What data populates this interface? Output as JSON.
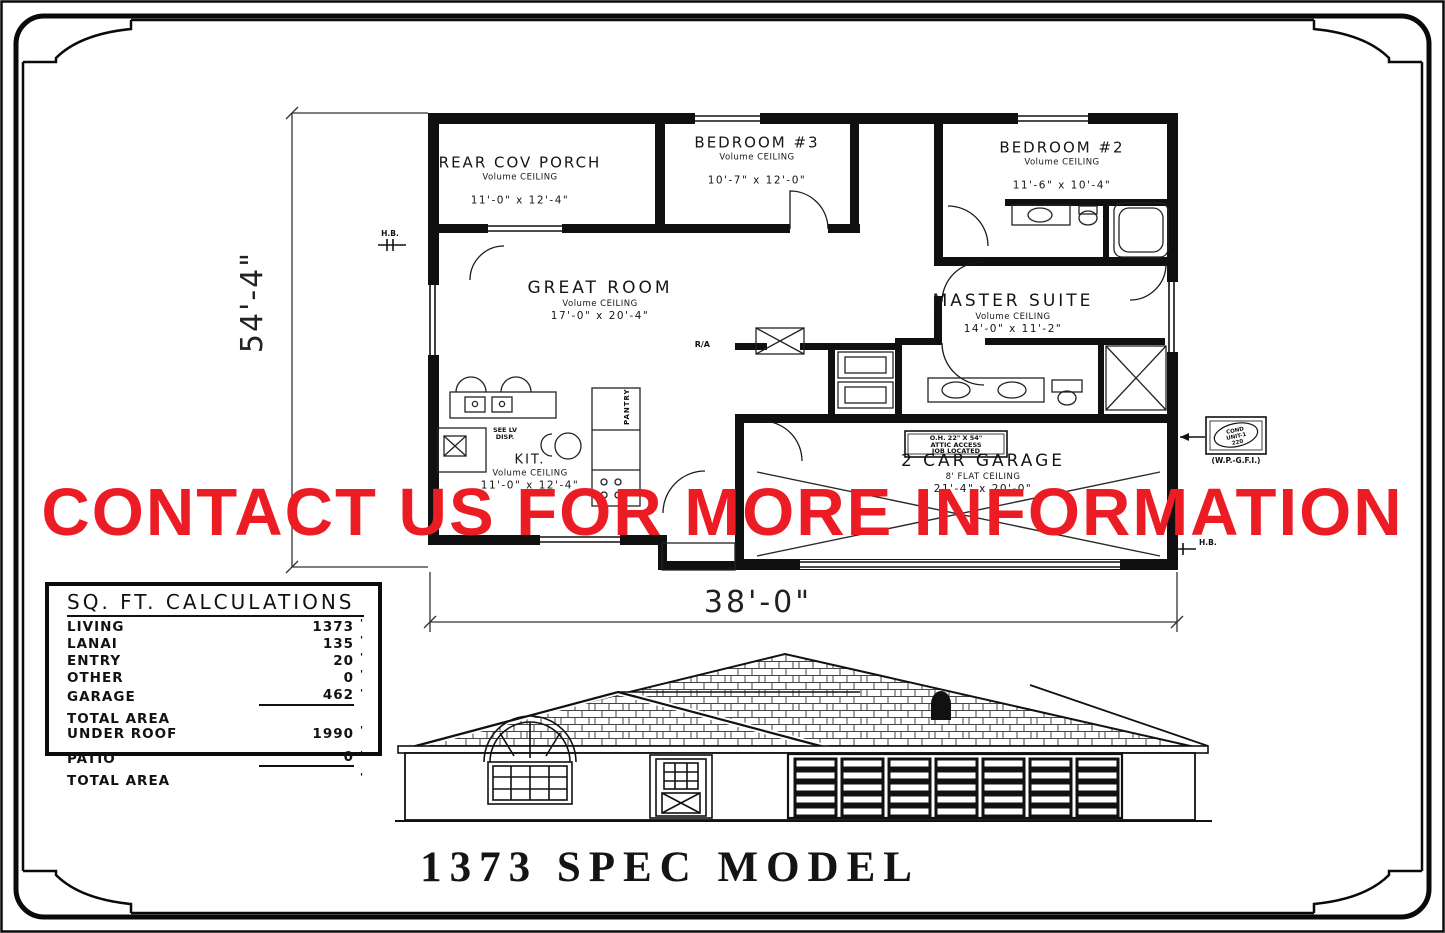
{
  "watermark": {
    "text": "CONTACT US FOR MORE INFORMATION",
    "color": "#ec1c24"
  },
  "title_block": {
    "text": "1373 SPEC MODEL"
  },
  "dims": {
    "height_label": "54'-4\"",
    "width_label": "38'-0\""
  },
  "rooms": [
    {
      "name": "REAR COV PORCH",
      "ceiling": "Volume CEILING",
      "size": "11'-0\" x 12'-4\""
    },
    {
      "name": "BEDROOM #3",
      "ceiling": "Volume CEILING",
      "size": "10'-7\" x 12'-0\""
    },
    {
      "name": "BEDROOM #2",
      "ceiling": "Volume CEILING",
      "size": "11'-6\" x 10'-4\""
    },
    {
      "name": "GREAT ROOM",
      "ceiling": "Volume CEILING",
      "size": "17'-0\" x 20'-4\""
    },
    {
      "name": "MASTER SUITE",
      "ceiling": "Volume CEILING",
      "size": "14'-0\" x 11'-2\""
    },
    {
      "name": "KIT.",
      "ceiling": "Volume CEILING",
      "size": "11'-0\" x 12'-4\""
    },
    {
      "name": "2 CAR GARAGE",
      "ceiling": "8' FLAT CEILING",
      "size": "21'-4\" x 20'-0\""
    }
  ],
  "ann": {
    "hb": "H.B.",
    "ra": "R/A",
    "pantry": "PANTRY",
    "see_lv": [
      "SEE LV",
      "DISP."
    ],
    "attic": [
      "O.H. 22\" X 54\"",
      "ATTIC ACCESS",
      "JOB LOCATED"
    ],
    "cond": [
      "COND",
      "UNIT-1",
      "220"
    ],
    "cond_label": "(W.P.-G.F.I.)"
  },
  "table": {
    "title": "SQ. FT. CALCULATIONS",
    "tick": "'",
    "rows": [
      {
        "label": "LIVING",
        "value": "1373"
      },
      {
        "label": "LANAI",
        "value": "135"
      },
      {
        "label": "ENTRY",
        "value": "20"
      },
      {
        "label": "OTHER",
        "value": "0"
      },
      {
        "label": "GARAGE",
        "value": "462"
      },
      {
        "label": "TOTAL AREA\nUNDER ROOF",
        "value": "1990"
      },
      {
        "label": "PATIO",
        "value": "0"
      },
      {
        "label": "TOTAL AREA",
        "value": ""
      }
    ]
  }
}
